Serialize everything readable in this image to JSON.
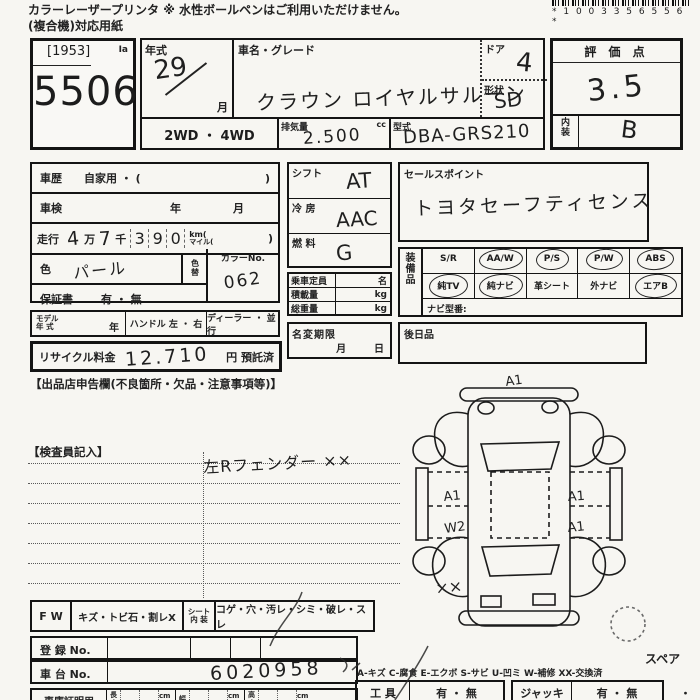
{
  "header": {
    "note1": "カラーレーザープリンタ ※ 水性ボールペンはご利用いただけません。",
    "note2": "(複合機)対応用紙",
    "barcode": "* 1 0 0 3 3 5 6 5 5 6 *"
  },
  "lot": {
    "bracket": "[1953]",
    "mark": "Ia",
    "number": "5506"
  },
  "info": {
    "year_label": "年式",
    "year_value": "29",
    "month_label": "月",
    "name_label": "車名・グレード",
    "name_value": "クラウン ロイヤルサルーン",
    "door_label": "ドア",
    "door_value": "4",
    "shape_label": "形状",
    "shape_value": "SD",
    "drive": "2WD ・ 4WD",
    "disp_label": "排気量",
    "disp_unit": "cc",
    "disp_value": "2.500",
    "model_label": "型式",
    "model_value": "DBA-GRS210"
  },
  "rating": {
    "title": "評 価 点",
    "score": "3.5",
    "interior_label": "内\n装",
    "interior_value": "B"
  },
  "history": {
    "r1_label": "車歴",
    "r1_value": "自家用 ・ (",
    "r1_close": ")",
    "r2_label": "車検",
    "r2_year": "年",
    "r2_month": "月",
    "mileage": {
      "label": "走行",
      "man": "4",
      "man_unit": "万",
      "sen": "7",
      "sen_unit": "千",
      "d1": "3",
      "d2": "9",
      "d3": "0",
      "km": "km(",
      "mile": "マイル(",
      "close": ")"
    },
    "color_label": "色",
    "color_value": "パール",
    "color_change": "色\n替",
    "color_no_label": "カラーNo.",
    "color_no_value": "062",
    "warranty_label": "保証書",
    "warranty_value": "有 ・ 無"
  },
  "middle": {
    "shift_label": "シフト",
    "shift_value": "AT",
    "ac_label": "冷  房",
    "ac_value": "AAC",
    "fuel_label": "燃  料",
    "fuel_value": "G",
    "capacity_label": "乗車定員",
    "capacity_unit": "名",
    "load_label": "積載量",
    "load_unit": "kg",
    "weight_label": "総重量",
    "weight_unit": "kg",
    "rename_label": "名変期限",
    "rename_value": "月        日"
  },
  "sales": {
    "label": "セールスポイント",
    "value": "トヨタセーフティセンス"
  },
  "equipment": {
    "side": "装\n備\n品",
    "row1": [
      {
        "label": "S/R",
        "circled": false
      },
      {
        "label": "AA/W",
        "circled": true
      },
      {
        "label": "P/S",
        "circled": true
      },
      {
        "label": "P/W",
        "circled": true
      },
      {
        "label": "ABS",
        "circled": true
      }
    ],
    "row2": [
      {
        "label": "純TV",
        "circled": true
      },
      {
        "label": "純ナビ",
        "circled": true
      },
      {
        "label": "革シート",
        "circled": false
      },
      {
        "label": "外ナビ",
        "circled": false
      },
      {
        "label": "エアB",
        "circled": true
      }
    ],
    "navi": "ナビ型番:"
  },
  "later": {
    "label": "後日品"
  },
  "model_row": {
    "c1": "モデル\n年 式",
    "c1_unit": "年",
    "c2": "ハンドル 左 ・ 右",
    "c3": "ディーラー ・ 並行"
  },
  "recycle": {
    "label": "リサイクル料金",
    "value": "12.710",
    "suffix": "円 預託済"
  },
  "declaration": "【出品店申告欄(不良箇所・欠品・注意事項等)】",
  "inspector": {
    "label": "【検査員記入】",
    "note": "左Rフェンダー ××"
  },
  "diagram": {
    "front": "A1",
    "left_front": "A1",
    "left_rear": "W2",
    "right_front": "A1",
    "right_rear": "A1",
    "fender": "××",
    "spare": "スペア"
  },
  "bottom": {
    "fw_label": "F W",
    "fw_value": "キズ・トビ石・割レX",
    "seat_label": "シート\n内 装",
    "seat_value": "コゲ・穴・汚レ・シミ・破レ・スレ",
    "reg_label": "登 録 No.",
    "chassis_label": "車 台 No.",
    "chassis_value": "6020958",
    "garage_label": "車庫証明用",
    "len": "長\nさ",
    "wid": "幅",
    "hei": "高\nさ",
    "cm": "cm",
    "legend": "A-キズ C-腐食 E-エクボ S-サビ U-凹ミ W-補修 XX-交換済",
    "tool_label": "工  具",
    "tool_value": "有 ・ 無",
    "jack_label": "ジャッキ",
    "jack_value": "有 ・ 無",
    "dot": "・"
  }
}
